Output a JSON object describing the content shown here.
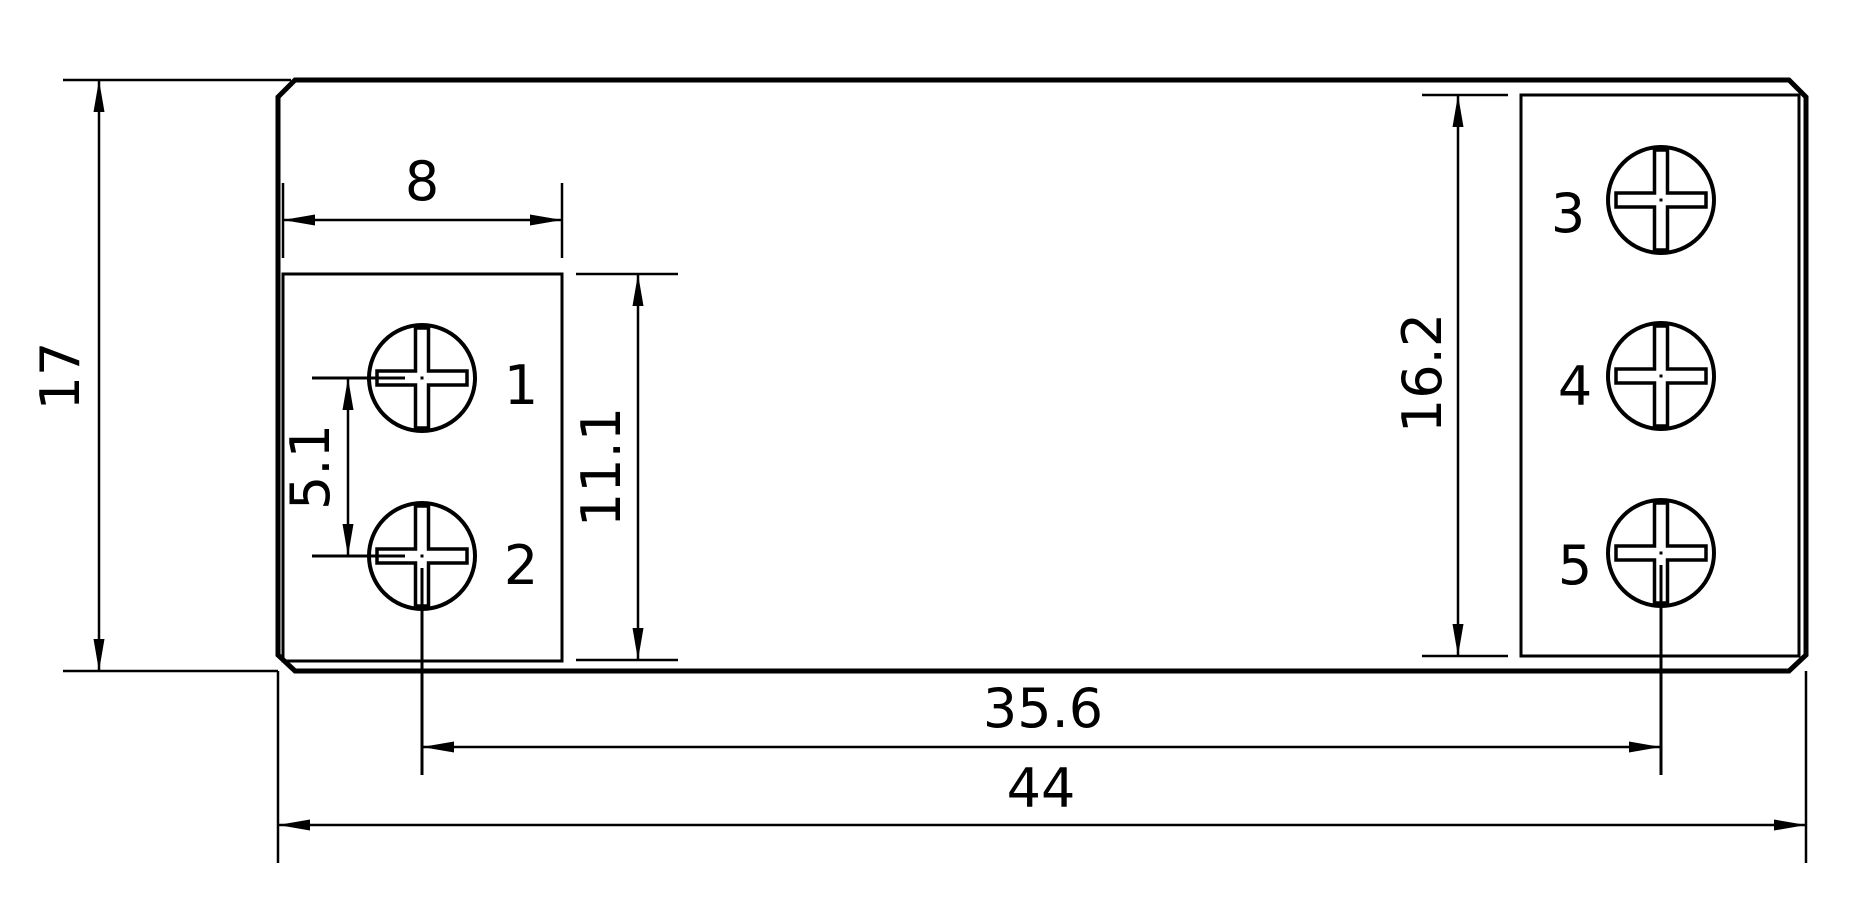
{
  "drawing": {
    "description": "dimensioned footprint drawing of a 5-terminal module",
    "dimensions": {
      "overall_height": "17",
      "overall_width": "44",
      "left_block_width": "8",
      "left_screw_pitch": "5.1",
      "left_block_height": "11.1",
      "right_block_height": "16.2",
      "screw_span": "35.6"
    },
    "terminals": {
      "labels": [
        "1",
        "2",
        "3",
        "4",
        "5"
      ]
    },
    "colors": {
      "line": "#000000",
      "label": "#ed1c24",
      "background": "#ffffff"
    }
  }
}
